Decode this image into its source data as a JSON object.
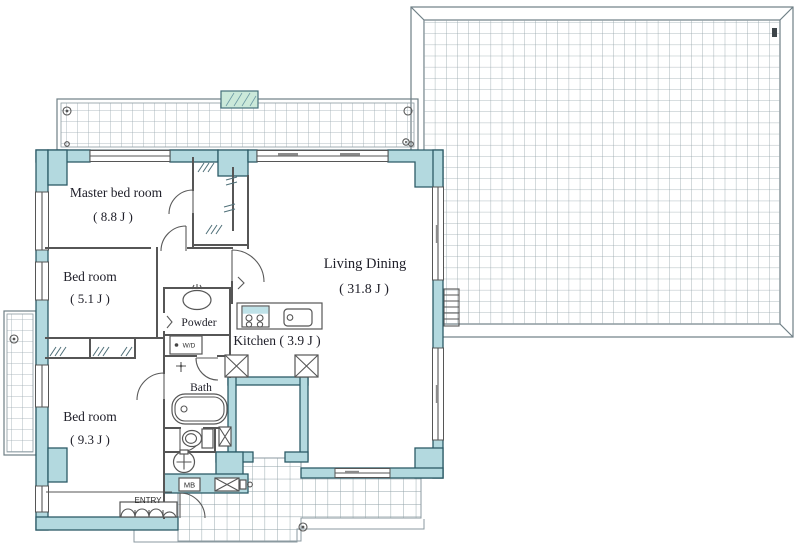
{
  "page": {
    "type": "apartment-floor-plan",
    "background": "#ffffff"
  },
  "colors": {
    "wall_fill": "#b3d9df",
    "wall_stroke": "#2c5b67",
    "partition_line": "#565656",
    "grid_line": "#9aa9af",
    "frame_line": "#6f7f86",
    "vent_green": "#cbe9da",
    "text": "#20202a"
  },
  "rooms": {
    "master_bedroom": {
      "label": "Master bed room",
      "area": "( 8.8 J )"
    },
    "bedroom_5_1": {
      "label": "Bed room",
      "area": "( 5.1 J )"
    },
    "bedroom_9_3": {
      "label": "Bed room",
      "area": "( 9.3 J )"
    },
    "living_dining": {
      "label": "Living Dining",
      "area": "( 31.8 J )"
    },
    "kitchen": {
      "label": "Kitchen ( 3.9 J )"
    },
    "powder": {
      "label": "Powder"
    },
    "bath": {
      "label": "Bath"
    },
    "entry": {
      "label": "ENTRY"
    }
  },
  "annotations": {
    "meter_box": "MB",
    "washer_dryer": "W/D"
  }
}
